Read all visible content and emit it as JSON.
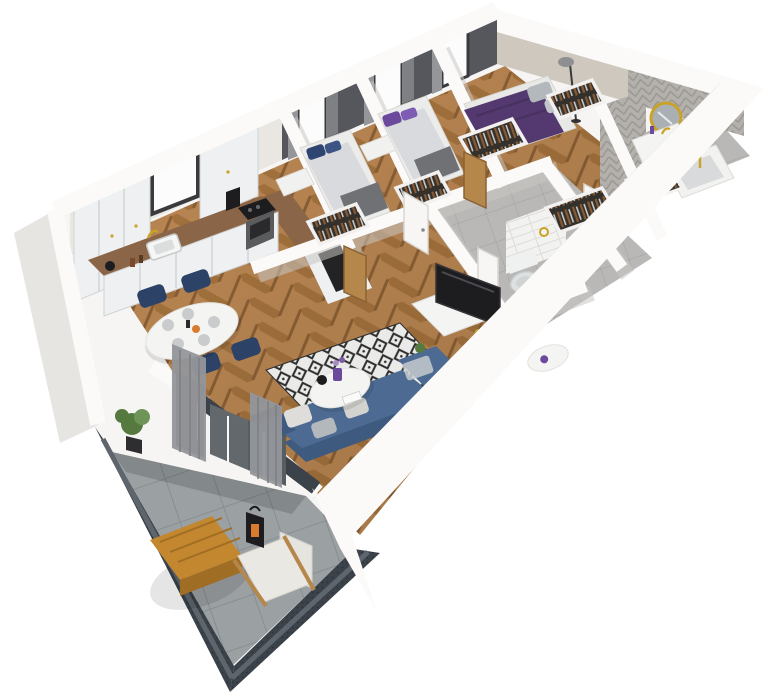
{
  "scene": {
    "type": "3d-floor-plan-render",
    "view": "isometric-dollhouse-cutaway",
    "rooms": [
      {
        "name": "kitchen",
        "items": [
          "upper-cabinets",
          "tall-cabinet",
          "window",
          "marble-backsplash",
          "wood-countertop",
          "sink",
          "gold-faucet",
          "cooktop",
          "oven",
          "coffee-machine",
          "kettle",
          "base-cabinets"
        ]
      },
      {
        "name": "dining-area",
        "items": [
          "oval-white-table",
          "navy-chair",
          "navy-chair",
          "navy-chair",
          "navy-chair",
          "plates",
          "fruit-bowl"
        ]
      },
      {
        "name": "living-room",
        "items": [
          "corner-sofa-blue",
          "pillows",
          "diamond-pattern-rug",
          "round-coffee-table",
          "purple-vase",
          "side-table",
          "tv",
          "tv-stand",
          "radiator",
          "curtains",
          "balcony-glass-door",
          "plant"
        ]
      },
      {
        "name": "bedroom-1",
        "items": [
          "single-bed",
          "navy-pillows",
          "desk",
          "wardrobe-with-clothes",
          "oak-door",
          "window",
          "curtains"
        ]
      },
      {
        "name": "bedroom-2",
        "items": [
          "single-bed",
          "purple-pillows",
          "desk",
          "wardrobe-with-clothes",
          "oak-door",
          "window",
          "curtains"
        ]
      },
      {
        "name": "master-bedroom",
        "items": [
          "double-bed-purple-duvet",
          "gray-pillows",
          "floor-lamp",
          "wardrobe-with-clothes",
          "closet",
          "window",
          "curtains"
        ]
      },
      {
        "name": "bathroom",
        "items": [
          "herringbone-tile-walls",
          "round-gold-mirror",
          "vanity-with-sink",
          "gold-faucet",
          "bathtub",
          "towel-shelf",
          "gold-shower-set",
          "white-door"
        ]
      },
      {
        "name": "wc",
        "items": [
          "wall-hung-toilet",
          "white-subway-tile-wall",
          "gold-towel-ring",
          "dark-niche"
        ]
      },
      {
        "name": "hallway",
        "items": [
          "gray-tile-floor",
          "open-white-door",
          "closet-with-clothes"
        ]
      },
      {
        "name": "balcony",
        "items": [
          "graphite-railing",
          "gray-tile-floor",
          "wood-table",
          "white-armchair",
          "black-lantern",
          "potted-plant",
          "entry-panel"
        ]
      }
    ]
  },
  "colors": {
    "bg": "#ffffff",
    "wall_white": "#f6f5f3",
    "wall_bevel": "#e7e5e1",
    "wall_shadow": "#d3d1cd",
    "roof_white": "#fbfaf9",
    "dark_wall": "#56575c",
    "beige_wall": "#cfc8bf",
    "glass": "#fcfcfd",
    "frame_dark": "#3a3a3e",
    "curtain": "#94969a",
    "curtain_dark": "#7e8084",
    "wood_a": "#c08b55",
    "wood_b": "#a9763f",
    "wood_line": "#8f6236",
    "tile": "#b9b8b6",
    "tile_line": "#a5a4a2",
    "balcony_tile": "#9ba0a3",
    "balcony_tile_line": "#83888b",
    "balustrade": "#3b424a",
    "balustrade_light": "#5e656d",
    "cabinet": "#eef0f1",
    "cabinet_line": "#d0d3d5",
    "counter_wood": "#8a6547",
    "marble": "#eae7e3",
    "gold": "#c9a227",
    "black": "#1d1d1f",
    "appliance_gray": "#595b5d",
    "sofa_blue": "#4d6b92",
    "sofa_blue_dark": "#3e5a7f",
    "pillow_light": "#deddd9",
    "pillow_gray": "#b3b8bd",
    "rug_base": "#eaeae8",
    "rug_black": "#2e2e2e",
    "table_white": "#f4f4f2",
    "chair_navy": "#2d4267",
    "bed_duvet": "#d9dadd",
    "bed_blanket": "#6f7174",
    "pillow_navy": "#2f4571",
    "pillow_purple": "#6b4a9e",
    "master_purple": "#53396f",
    "oak": "#b5874b",
    "toilet_white": "#dde0e1",
    "subway": "#f2f2f0",
    "subway_line": "#dddcd8",
    "chevron": "#b4b1ac",
    "chevron_line": "#9a9792",
    "mirror_glass": "#a9afb3",
    "towel_brown": "#8a5a32",
    "clothes_dark": "#34302c",
    "clothes_light": "#c8c8c6",
    "plant_green": "#55793f",
    "plant_light": "#6f9457",
    "wood_table": "#c2872f",
    "wood_table_dark": "#a06d24",
    "armchair": "#e9e8e3",
    "lantern_orange": "#d97b2e",
    "door_gray": "#4a4f55",
    "glass_door": "#63686d"
  }
}
